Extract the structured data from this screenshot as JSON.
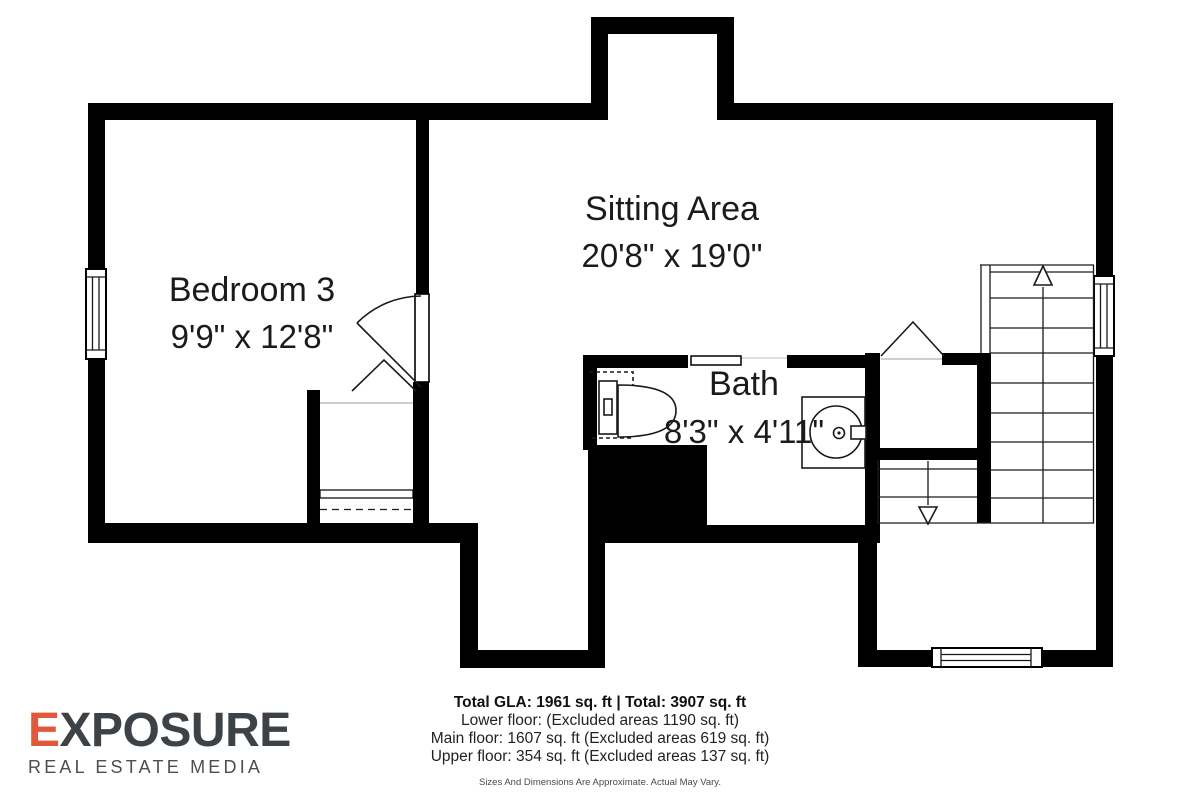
{
  "colors": {
    "wall": "#000000",
    "text": "#1b1b1b",
    "line": "#1a1a1a",
    "muted": "#4a4a4a",
    "logo_accent": "#e0593c",
    "logo_dark": "#3d4247",
    "logo_sub": "#4b4f55"
  },
  "rooms": [
    {
      "id": "bedroom3",
      "name": "Bedroom 3",
      "dimensions": "9'9\" x 12'8\""
    },
    {
      "id": "sitting",
      "name": "Sitting Area",
      "dimensions": "20'8\" x 19'0\""
    },
    {
      "id": "bath",
      "name": "Bath",
      "dimensions": "8'3\" x 4'11\""
    }
  ],
  "footer": {
    "total_line": "Total GLA: 1961 sq. ft | Total: 3907 sq. ft",
    "lower_line": "Lower floor: (Excluded areas 1190 sq. ft)",
    "main_line": "Main floor: 1607 sq. ft (Excluded areas 619 sq. ft)",
    "upper_line": "Upper floor: 354 sq. ft (Excluded areas 137 sq. ft)",
    "disclaimer": "Sizes And Dimensions Are Approximate. Actual May Vary."
  },
  "logo": {
    "name_accent": "E",
    "name_rest": "XPOSURE",
    "subtitle": "REAL ESTATE MEDIA"
  },
  "icons": {
    "stairs_up": "arrow-up-icon",
    "stairs_down": "arrow-down-icon"
  }
}
